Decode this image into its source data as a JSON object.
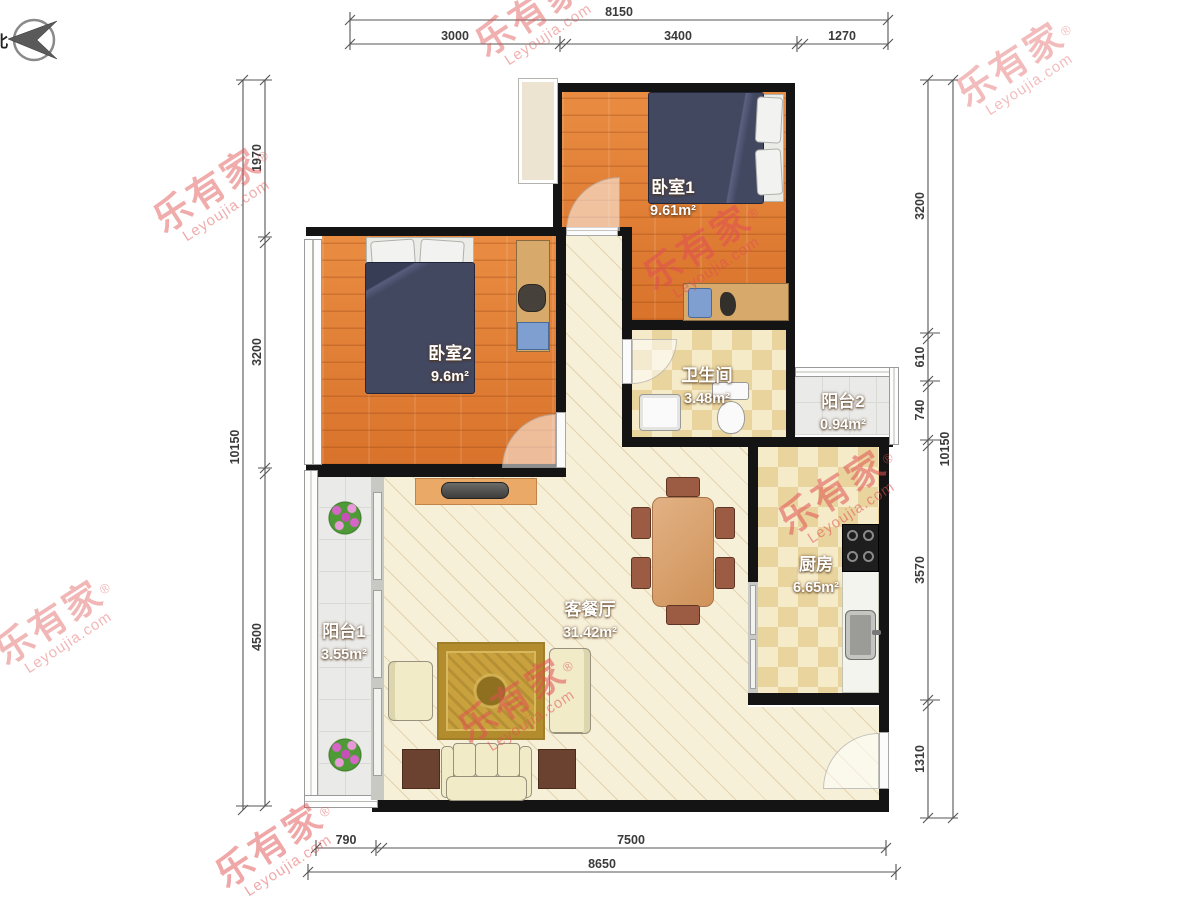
{
  "compass": {
    "label": "北"
  },
  "watermark": {
    "brand": "乐有家",
    "domain": "Leyoujia.com",
    "reg": "®"
  },
  "rooms": {
    "bedroom1": {
      "name": "卧室1",
      "area": "9.61m²"
    },
    "bedroom2": {
      "name": "卧室2",
      "area": "9.6m²"
    },
    "bathroom": {
      "name": "卫生间",
      "area": "3.48m²"
    },
    "balcony2": {
      "name": "阳台2",
      "area": "0.94m²"
    },
    "kitchen": {
      "name": "厨房",
      "area": "6.65m²"
    },
    "living": {
      "name": "客餐厅",
      "area": "31.42m²"
    },
    "balcony1": {
      "name": "阳台1",
      "area": "3.55m²"
    }
  },
  "dimensions": {
    "top": {
      "total": "8150",
      "segments": [
        "3000",
        "3400",
        "1270"
      ]
    },
    "bottom": {
      "total": "8650",
      "segments": [
        "790",
        "7500"
      ]
    },
    "left": {
      "total": "10150",
      "segments": [
        "1970",
        "3200",
        "4500"
      ]
    },
    "right": {
      "total": "10150",
      "segments": [
        "3200",
        "610",
        "740",
        "3570",
        "1310"
      ]
    }
  }
}
